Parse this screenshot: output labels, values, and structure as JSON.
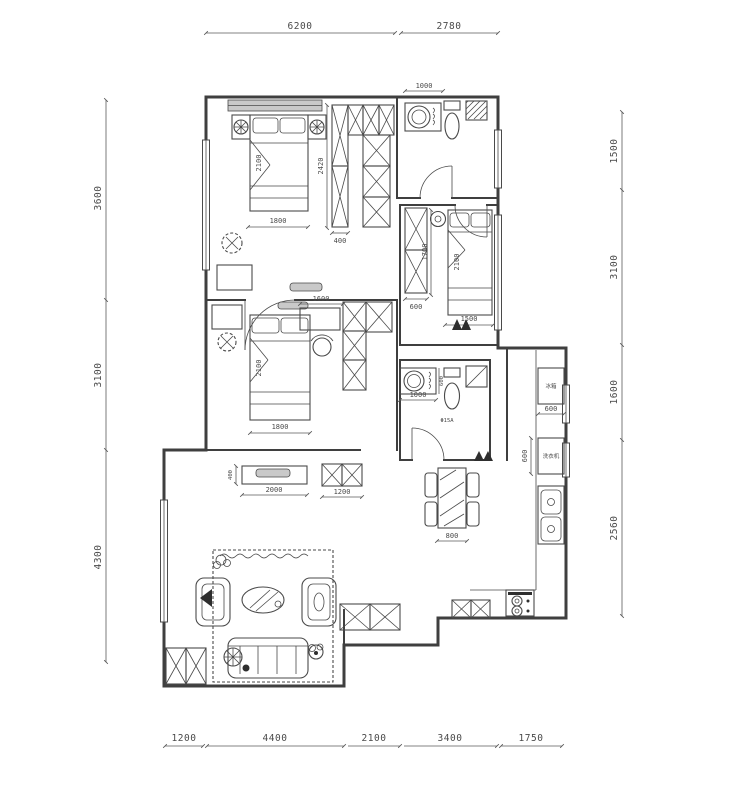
{
  "drawing": {
    "type": "apartment floor plan",
    "colors": {
      "wall": "#3f3f3f",
      "furniture": "#4a4a4a",
      "dimension": "#5a5a5a",
      "window_fill": "#c9c9c9",
      "background": "#ffffff"
    }
  },
  "dims": {
    "top": [
      "6200",
      "2780"
    ],
    "left": [
      "3600",
      "3100",
      "4300"
    ],
    "right": [
      "1500",
      "3100",
      "1600",
      "2560"
    ],
    "bottom": [
      "1200",
      "4400",
      "2100",
      "3400",
      "1750"
    ]
  },
  "interior": {
    "bath1_vanity_width": "1000",
    "closet_height": "2420",
    "closet_width": "400",
    "bed1_length": "2100",
    "bed1_width": "1800",
    "bed2_wardrobe_width": "600",
    "bed2_side": "1700",
    "bed2_length": "2100",
    "bed2_width": "1500",
    "desk3_width": "1600",
    "bed3_length": "2100",
    "bed3_width": "1800",
    "bath2_vanity_width": "1000",
    "bath2_vanity_depth": "600",
    "bath2_note": "Φ15A",
    "fridge_width": "600",
    "counter_depth": "600",
    "tv_cabinet_width": "2000",
    "tv_cabinet_depth": "400",
    "shoe_cabinet_width": "1200",
    "dining_table_width": "800"
  },
  "labels": {
    "fridge": "冰箱",
    "washer": "洗衣机"
  }
}
